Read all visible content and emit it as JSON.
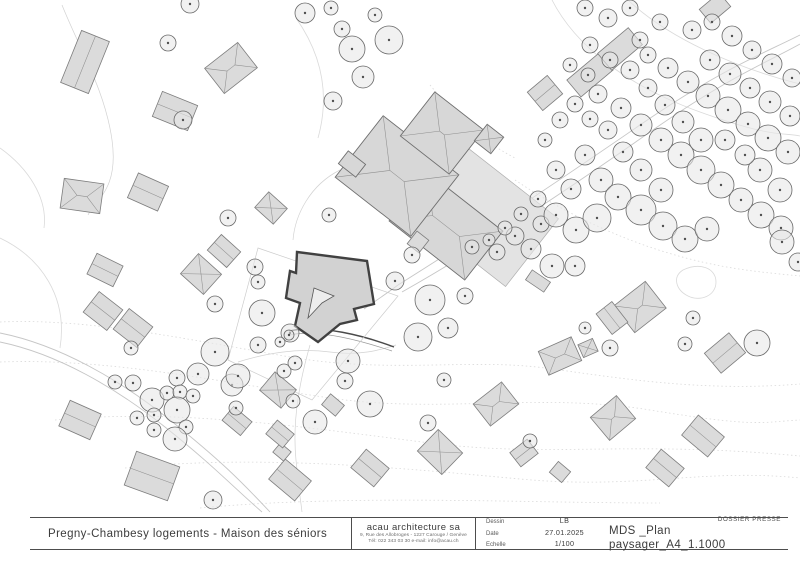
{
  "title_block": {
    "project_title": "Pregny-Chambesy logements - Maison des séniors",
    "firm": {
      "name": "acau architecture sa",
      "address": "9, Rue des Allobroges - 1227 Carouge / Genève",
      "contact": "Tél: 022 343 03 30   e-mail: info@acau.ch"
    },
    "table": {
      "rows": [
        {
          "label": "Dessin",
          "value": "LB"
        },
        {
          "label": "Date",
          "value": "27.01.2025"
        },
        {
          "label": "Echelle",
          "value": "1/100"
        }
      ]
    },
    "doc_type": "DOSSIER PRESSE",
    "doc_title": "MDS _Plan paysager_A4_1.1000"
  },
  "plan": {
    "colors": {
      "building_fill": "#dbdbdb",
      "building_stroke": "#7d7d7d",
      "project_outline": "#414141",
      "tree_stroke": "#686868",
      "contour": "#dadada",
      "paper": "#ffffff"
    },
    "contours": [
      {
        "d": "M 0,322 C 90,318 190,340 290,357 S 470,358 545,368 S 700,392 800,384",
        "dotted": true
      },
      {
        "d": "M 0,362 C 110,358 220,382 330,398 S 540,392 650,410 S 760,422 800,420",
        "dotted": true
      },
      {
        "d": "M 55,420 C 180,408 310,428 430,443 S 630,440 800,456",
        "dotted": true
      },
      {
        "d": "M 125,468 C 260,454 400,468 520,479 S 700,468 800,478",
        "dotted": true
      },
      {
        "d": "M 200,508 C 350,494 520,503 660,503",
        "dotted": true
      },
      {
        "d": "M 515,180 C 560,210 610,235 665,252 S 760,272 800,276",
        "dotted": true
      },
      {
        "d": "M 430,85 C 455,115 480,140 515,158",
        "dotted": true
      },
      {
        "d": "M 552,0 C 575,45 625,85 700,112 S 782,132 800,136",
        "dotted": false
      },
      {
        "d": "M 628,0 C 668,38 736,68 800,84",
        "dotted": false
      },
      {
        "d": "M 0,238 C 42,258 68,298 60,348",
        "dotted": false
      },
      {
        "d": "M 0,148 C 28,168 48,198 44,228",
        "dotted": false
      },
      {
        "d": "M 296,18 C 322,55 330,95 318,138",
        "dotted": false
      },
      {
        "d": "M 683,270 C 700,262 716,268 716,282 C 716,296 700,302 688,296 C 676,290 672,277 683,270 Z",
        "dotted": false
      }
    ],
    "roads": [
      {
        "d": "M 398,285 C 470,240 560,180 640,125 S 760,55 800,35",
        "cls": "road"
      },
      {
        "d": "M 402,292 C 480,248 570,188 650,132 S 768,62 800,44",
        "cls": "road"
      },
      {
        "d": "M 398,285 C 386,294 374,302 364,309",
        "cls": "road"
      },
      {
        "d": "M 0,333 C 60,345 120,380 170,420 S 240,480 270,512",
        "cls": "road"
      },
      {
        "d": "M 0,342 C 58,354 116,388 165,427 S 232,486 262,512",
        "cls": "road"
      },
      {
        "d": "M 62,5 C 80,50 105,90 112,140 S 95,200 88,215",
        "cls": "roadf"
      },
      {
        "d": "M 340,170 C 310,185 295,215 293,240",
        "cls": "roadf"
      },
      {
        "d": "M 238,362 C 270,352 300,348 330,352 C 360,356 380,350 396,345",
        "cls": "roadf"
      },
      {
        "d": "M 310,345 C 300,380 292,420 296,460 S 300,495 302,512",
        "cls": "roadf"
      },
      {
        "d": "M 289,335 C 320,329 362,341 392,351",
        "cls": "hedge2"
      },
      {
        "d": "M 289,331 C 320,324 365,336 394,347",
        "cls": "hedge"
      }
    ],
    "parcel_outline": "258,248 398,296 312,400 228,360",
    "houses": [
      [
        85,
        62,
        30,
        56,
        22,
        "gable"
      ],
      [
        175,
        111,
        38,
        27,
        22,
        "gable"
      ],
      [
        231,
        68,
        42,
        32,
        -38,
        "hip"
      ],
      [
        82,
        196,
        40,
        30,
        8,
        "hip"
      ],
      [
        148,
        192,
        33,
        27,
        24,
        "gable"
      ],
      [
        271,
        208,
        25,
        21,
        42,
        "pyr"
      ],
      [
        105,
        270,
        29,
        23,
        26,
        "gable"
      ],
      [
        201,
        274,
        31,
        27,
        42,
        "pyr"
      ],
      [
        224,
        251,
        26,
        21,
        42,
        "gable"
      ],
      [
        103,
        311,
        30,
        26,
        38,
        "gable"
      ],
      [
        133,
        328,
        30,
        26,
        38,
        "gable"
      ],
      [
        152,
        476,
        46,
        36,
        20,
        "gable"
      ],
      [
        237,
        421,
        24,
        18,
        40,
        "gable"
      ],
      [
        290,
        480,
        34,
        26,
        40,
        "gable"
      ],
      [
        333,
        405,
        18,
        14,
        40,
        "flat"
      ],
      [
        370,
        468,
        30,
        24,
        40,
        "gable"
      ],
      [
        440,
        452,
        34,
        30,
        44,
        "pyr"
      ],
      [
        496,
        404,
        36,
        28,
        -38,
        "hip"
      ],
      [
        524,
        453,
        22,
        18,
        -38,
        "gable"
      ],
      [
        282,
        452,
        14,
        12,
        40,
        "flat"
      ],
      [
        613,
        418,
        34,
        30,
        -40,
        "hip"
      ],
      [
        665,
        468,
        30,
        24,
        40,
        "gable"
      ],
      [
        703,
        436,
        34,
        26,
        40,
        "gable"
      ],
      [
        560,
        472,
        16,
        14,
        40,
        "flat"
      ],
      [
        640,
        307,
        40,
        34,
        -38,
        "hip"
      ],
      [
        612,
        318,
        20,
        26,
        -38,
        "gable"
      ],
      [
        560,
        356,
        36,
        26,
        -24,
        "hip"
      ],
      [
        588,
        348,
        16,
        14,
        -24,
        "pyr"
      ],
      [
        725,
        353,
        32,
        26,
        -40,
        "gable"
      ],
      [
        545,
        93,
        26,
        24,
        -40,
        "gable"
      ],
      [
        590,
        75,
        42,
        22,
        -40,
        "flat"
      ],
      [
        620,
        49,
        40,
        22,
        -40,
        "flat"
      ],
      [
        418,
        242,
        15,
        16,
        38,
        "flat"
      ],
      [
        538,
        281,
        22,
        12,
        34,
        "flat"
      ],
      [
        715,
        8,
        26,
        18,
        -40,
        "flat"
      ],
      [
        80,
        420,
        34,
        28,
        24,
        "gable"
      ],
      [
        278,
        390,
        28,
        24,
        40,
        "pyr"
      ],
      [
        280,
        434,
        22,
        18,
        40,
        "gable"
      ]
    ],
    "chateau": [
      [
        480,
        212,
        132,
        86,
        38,
        "flat",
        "terrace"
      ],
      [
        446,
        226,
        96,
        62,
        38,
        "hip",
        "chateau"
      ],
      [
        397,
        176,
        96,
        78,
        38,
        "hip",
        "chateau"
      ],
      [
        442,
        133,
        62,
        56,
        38,
        "hip",
        "chateau"
      ],
      [
        489,
        139,
        21,
        21,
        38,
        "pyr",
        "chateau"
      ],
      [
        352,
        164,
        22,
        16,
        38,
        "flat",
        "chateau"
      ]
    ],
    "project": {
      "outline": "297,252 367,261 374,304 354,309 357,320 340,324 318,342 295,326 300,303 286,298 290,271 296,273",
      "courtyard": "314,288 334,296 322,303 308,318"
    },
    "trees": [
      [
        497,
        252,
        8
      ],
      [
        515,
        236,
        9
      ],
      [
        531,
        249,
        10
      ],
      [
        541,
        224,
        8
      ],
      [
        521,
        214,
        7
      ],
      [
        538,
        199,
        8
      ],
      [
        556,
        215,
        12
      ],
      [
        576,
        230,
        13
      ],
      [
        597,
        218,
        14
      ],
      [
        571,
        189,
        10
      ],
      [
        556,
        170,
        9
      ],
      [
        585,
        155,
        10
      ],
      [
        601,
        180,
        12
      ],
      [
        618,
        197,
        13
      ],
      [
        641,
        210,
        15
      ],
      [
        663,
        226,
        14
      ],
      [
        685,
        239,
        13
      ],
      [
        707,
        229,
        12
      ],
      [
        661,
        190,
        12
      ],
      [
        641,
        170,
        11
      ],
      [
        623,
        152,
        10
      ],
      [
        608,
        130,
        9
      ],
      [
        590,
        119,
        8
      ],
      [
        575,
        104,
        8
      ],
      [
        598,
        94,
        9
      ],
      [
        621,
        108,
        10
      ],
      [
        641,
        125,
        11
      ],
      [
        661,
        140,
        12
      ],
      [
        681,
        155,
        13
      ],
      [
        701,
        170,
        14
      ],
      [
        721,
        185,
        13
      ],
      [
        741,
        200,
        12
      ],
      [
        761,
        215,
        13
      ],
      [
        781,
        228,
        12
      ],
      [
        701,
        140,
        12
      ],
      [
        683,
        122,
        11
      ],
      [
        665,
        105,
        10
      ],
      [
        648,
        88,
        9
      ],
      [
        630,
        70,
        9
      ],
      [
        648,
        55,
        8
      ],
      [
        668,
        68,
        10
      ],
      [
        688,
        82,
        11
      ],
      [
        708,
        96,
        12
      ],
      [
        728,
        110,
        13
      ],
      [
        748,
        124,
        12
      ],
      [
        768,
        138,
        13
      ],
      [
        788,
        152,
        12
      ],
      [
        710,
        60,
        10
      ],
      [
        730,
        74,
        11
      ],
      [
        750,
        88,
        10
      ],
      [
        770,
        102,
        11
      ],
      [
        790,
        116,
        10
      ],
      [
        692,
        30,
        9
      ],
      [
        712,
        22,
        8
      ],
      [
        732,
        36,
        10
      ],
      [
        752,
        50,
        9
      ],
      [
        772,
        64,
        10
      ],
      [
        792,
        78,
        9
      ],
      [
        660,
        22,
        8
      ],
      [
        610,
        60,
        8
      ],
      [
        588,
        75,
        7
      ],
      [
        560,
        120,
        8
      ],
      [
        545,
        140,
        7
      ],
      [
        760,
        170,
        12
      ],
      [
        780,
        190,
        12
      ],
      [
        745,
        155,
        10
      ],
      [
        725,
        140,
        10
      ],
      [
        570,
        65,
        7
      ],
      [
        590,
        45,
        8
      ],
      [
        640,
        40,
        8
      ],
      [
        585,
        8,
        8
      ],
      [
        608,
        18,
        9
      ],
      [
        630,
        8,
        8
      ],
      [
        782,
        242,
        12
      ],
      [
        798,
        262,
        9
      ],
      [
        472,
        247,
        7
      ],
      [
        489,
        240,
        6
      ],
      [
        505,
        228,
        7
      ],
      [
        305,
        13,
        10
      ],
      [
        331,
        8,
        7
      ],
      [
        352,
        49,
        13
      ],
      [
        389,
        40,
        14
      ],
      [
        342,
        29,
        8
      ],
      [
        363,
        77,
        11
      ],
      [
        333,
        101,
        9
      ],
      [
        190,
        4,
        9
      ],
      [
        168,
        43,
        8
      ],
      [
        183,
        120,
        9
      ],
      [
        375,
        15,
        7
      ],
      [
        329,
        215,
        7
      ],
      [
        258,
        282,
        7
      ],
      [
        262,
        313,
        13
      ],
      [
        290,
        333,
        9
      ],
      [
        280,
        342,
        5
      ],
      [
        228,
        218,
        8
      ],
      [
        215,
        304,
        8
      ],
      [
        255,
        267,
        8
      ],
      [
        412,
        255,
        8
      ],
      [
        395,
        281,
        9
      ],
      [
        430,
        300,
        15
      ],
      [
        418,
        337,
        14
      ],
      [
        448,
        328,
        10
      ],
      [
        465,
        296,
        8
      ],
      [
        284,
        371,
        7
      ],
      [
        295,
        363,
        7
      ],
      [
        348,
        361,
        12
      ],
      [
        370,
        404,
        13
      ],
      [
        315,
        422,
        12
      ],
      [
        345,
        381,
        8
      ],
      [
        232,
        385,
        11
      ],
      [
        215,
        352,
        14
      ],
      [
        198,
        374,
        11
      ],
      [
        177,
        378,
        8
      ],
      [
        238,
        376,
        12
      ],
      [
        152,
        400,
        12
      ],
      [
        167,
        393,
        7
      ],
      [
        180,
        392,
        7
      ],
      [
        193,
        396,
        7
      ],
      [
        137,
        418,
        7
      ],
      [
        154,
        415,
        7
      ],
      [
        177,
        410,
        13
      ],
      [
        186,
        427,
        7
      ],
      [
        175,
        439,
        12
      ],
      [
        154,
        430,
        7
      ],
      [
        131,
        348,
        7
      ],
      [
        115,
        382,
        7
      ],
      [
        133,
        383,
        8
      ],
      [
        289,
        335,
        5
      ],
      [
        258,
        345,
        8
      ],
      [
        236,
        408,
        7
      ],
      [
        293,
        401,
        7
      ],
      [
        428,
        423,
        8
      ],
      [
        444,
        380,
        7
      ],
      [
        213,
        500,
        9
      ],
      [
        552,
        266,
        12
      ],
      [
        575,
        266,
        10
      ],
      [
        610,
        348,
        8
      ],
      [
        685,
        344,
        7
      ],
      [
        757,
        343,
        13
      ],
      [
        693,
        318,
        7
      ],
      [
        530,
        441,
        7
      ],
      [
        585,
        328,
        6
      ]
    ]
  }
}
